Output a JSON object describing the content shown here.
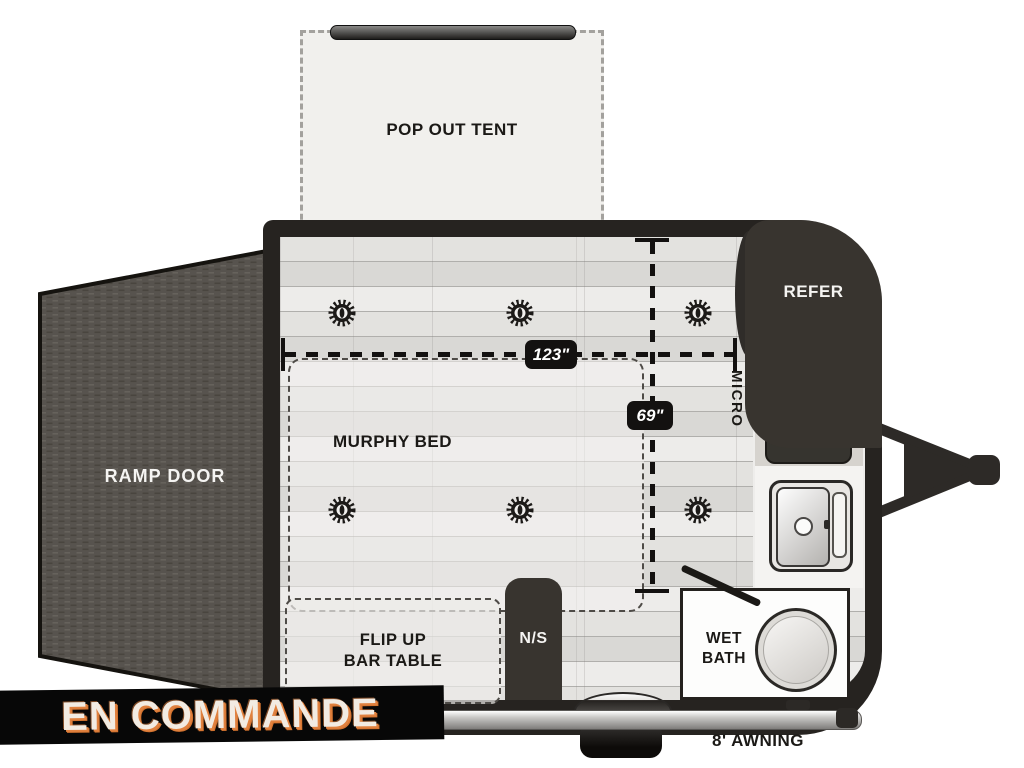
{
  "listing_status_banner": {
    "label": "EN COMMANDE"
  },
  "floorplan": {
    "pop_out_tent": {
      "label": "POP OUT TENT"
    },
    "ramp_door": {
      "label": "RAMP DOOR"
    },
    "murphy_bed": {
      "label": "MURPHY BED"
    },
    "flip_up_bar_table": {
      "line1": "FLIP UP",
      "line2": "BAR TABLE"
    },
    "nightstand": {
      "label": "N/S"
    },
    "wet_bath": {
      "line1": "WET",
      "line2": "BATH"
    },
    "refrigerator": {
      "label": "REFER"
    },
    "microwave": {
      "label": "MICRO"
    },
    "awning": {
      "label": "8' AWNING"
    },
    "dimensions": {
      "interior_length": "123\"",
      "interior_width": "69\""
    },
    "colors": {
      "wall": "#262320",
      "appliance_dark": "#38342f",
      "floor": "#dfdedb",
      "ramp_door": "#57534e",
      "banner_background": "#070707",
      "banner_text": "#f2ebe2",
      "banner_accent": "#e0813f"
    }
  }
}
